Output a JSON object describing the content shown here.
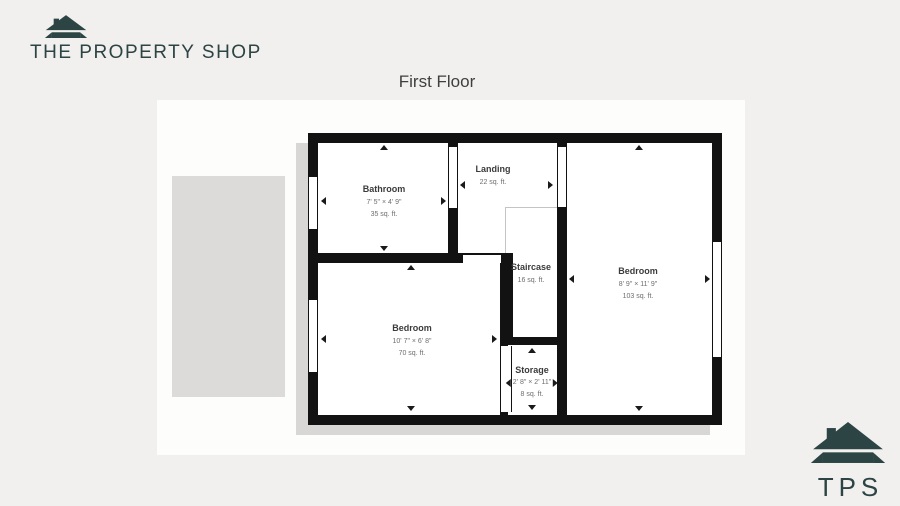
{
  "brand": {
    "name": "THE PROPERTY SHOP"
  },
  "plan": {
    "title": "First Floor",
    "rooms": {
      "bathroom": {
        "name": "Bathroom",
        "dims": "7' 5\" × 4' 9\"",
        "area": "35 sq. ft."
      },
      "landing": {
        "name": "Landing",
        "area": "22 sq. ft."
      },
      "staircase": {
        "name": "Staircase",
        "area": "16 sq. ft."
      },
      "bedroom_right": {
        "name": "Bedroom",
        "dims": "8' 9\" × 11' 9\"",
        "area": "103 sq. ft."
      },
      "bedroom_left": {
        "name": "Bedroom",
        "dims": "10' 7\" × 6' 8\"",
        "area": "70 sq. ft."
      },
      "storage": {
        "name": "Storage",
        "dims": "2' 8\" × 2' 11\"",
        "area": "8 sq. ft."
      }
    }
  },
  "footer_logo": {
    "text": "TPS"
  },
  "colors": {
    "brand_teal": "#2c4443",
    "wall": "#121212",
    "page_bg": "#f1f0ee",
    "shadow_gray": "#d8d7d5"
  }
}
